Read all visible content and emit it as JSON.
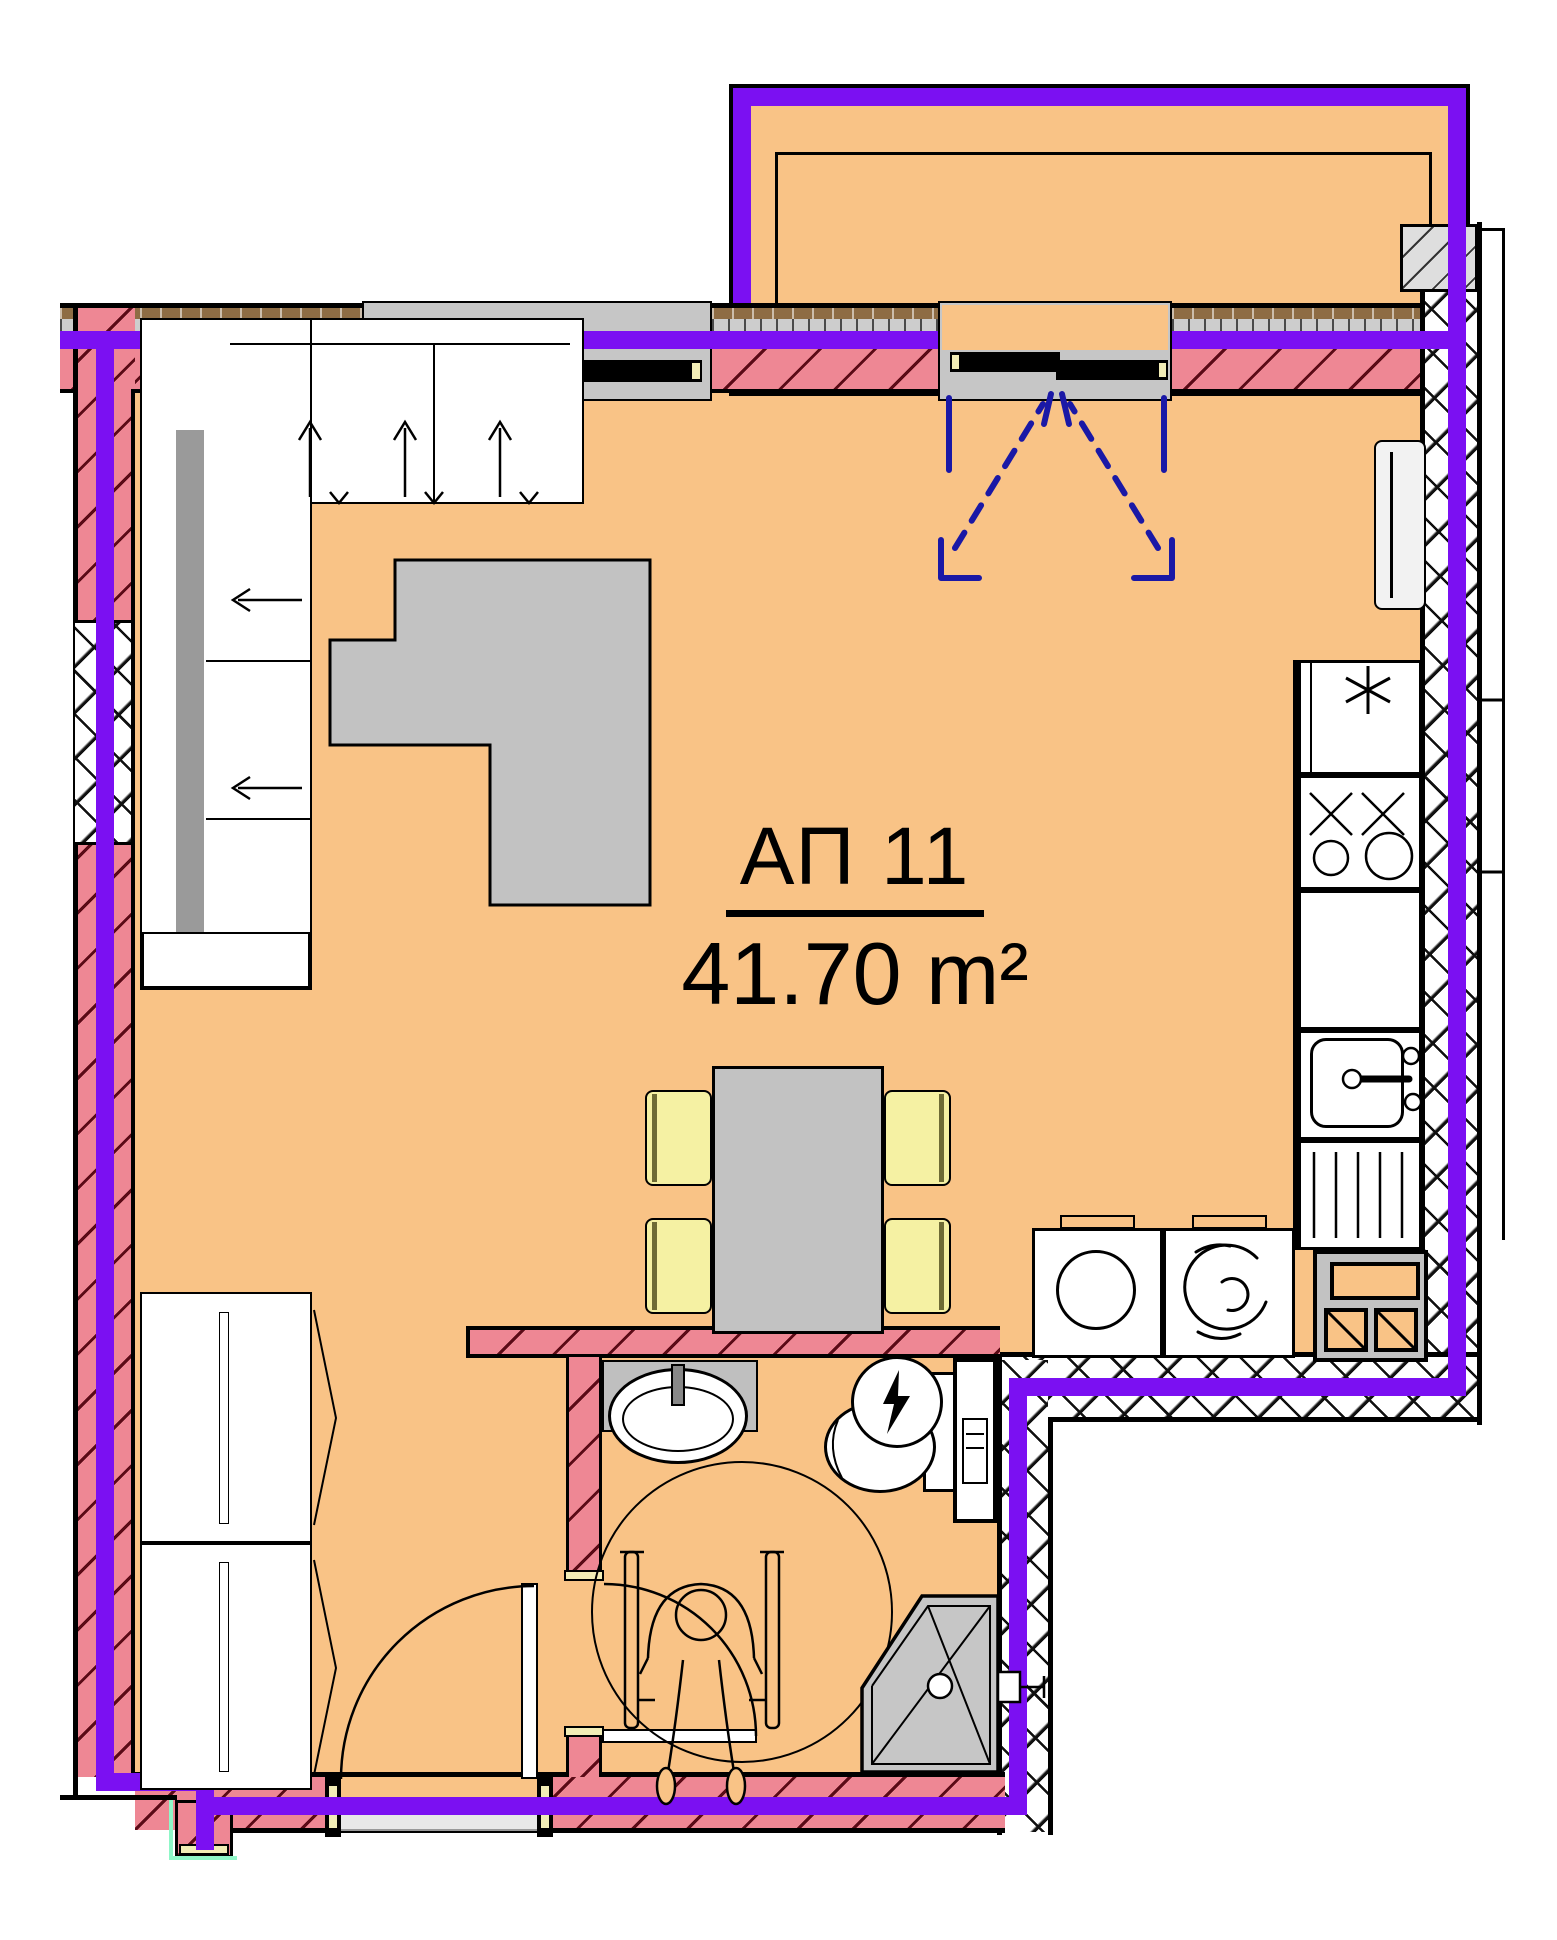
{
  "plan": {
    "unit_label": "АП 11",
    "area_label": "41.70 m²"
  },
  "colors": {
    "floor": "#F9C386",
    "wall_pink": "#EE8794",
    "wall_hatch": "#5A0A16",
    "boundary_purple": "#7B10F2",
    "furniture_gray": "#C2C2C2",
    "chair_yellow": "#F5F1A3",
    "frame_cream": "#F2EDB6",
    "door_swing_blue": "#1A18A6",
    "mint": "#8FF7C8",
    "reveal_gray": "#C6C6C6",
    "outline": "#000000"
  },
  "fixtures": [
    "balcony",
    "balcony-railing",
    "balcony-french-doors",
    "window",
    "corner-sofa",
    "coffee-table",
    "wardrobe",
    "dining-table",
    "chair",
    "fridge",
    "stove",
    "kitchen-sink",
    "kitchen-counter",
    "radiator",
    "washing-machine",
    "tumble-dryer",
    "ventilation-shaft",
    "bathroom-counter",
    "bathroom-sink",
    "water-heater",
    "toilet",
    "service-shaft",
    "shower-cabin",
    "wheelchair-accessibility",
    "turning-circle",
    "entrance-door",
    "bathroom-door"
  ]
}
